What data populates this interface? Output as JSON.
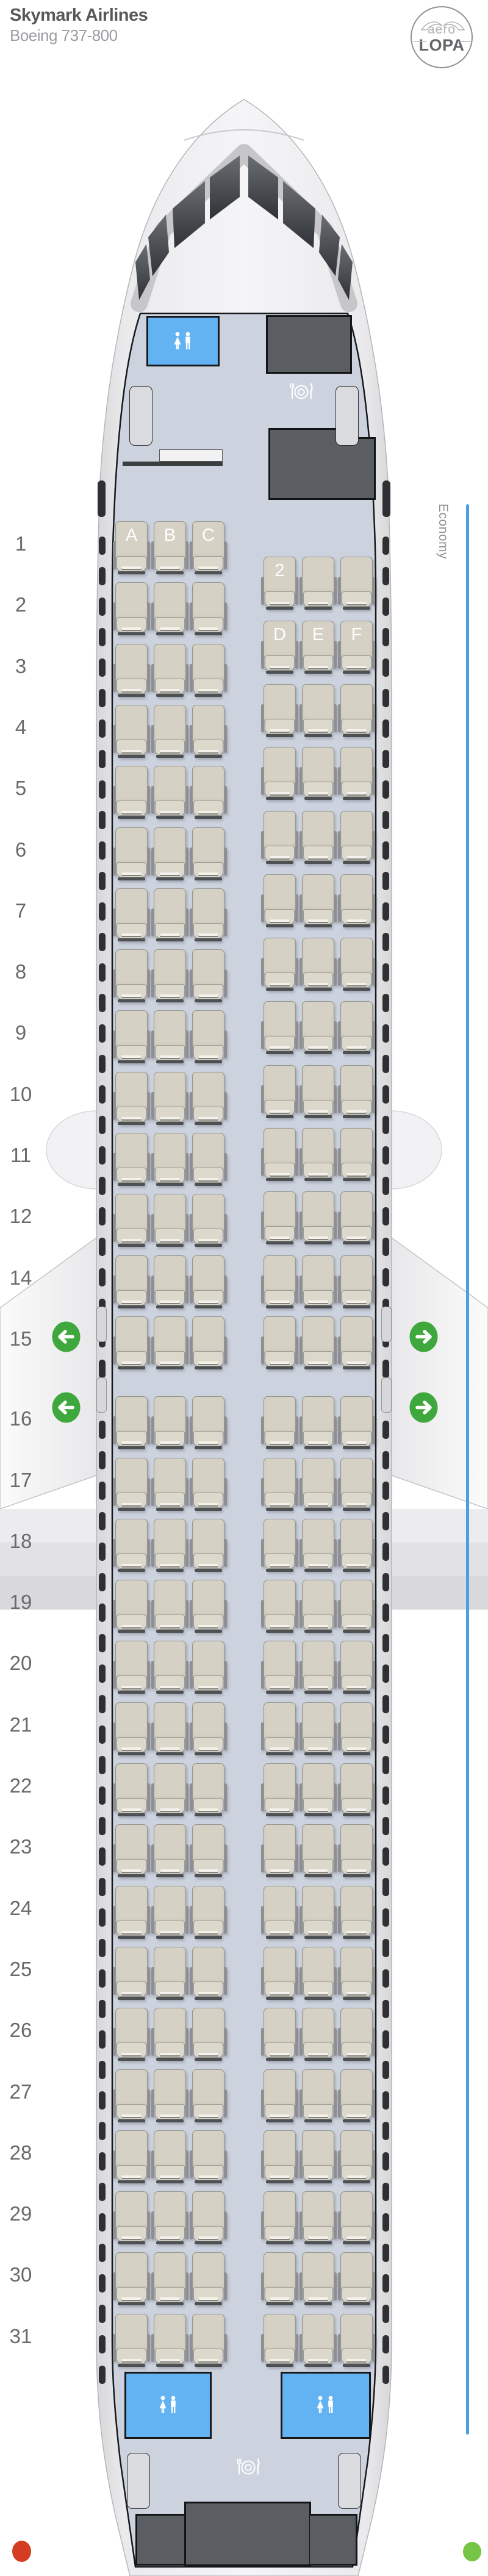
{
  "header": {
    "title": "Skymark Airlines",
    "subtitle": "Boeing 737-800"
  },
  "logo": {
    "top": "aero",
    "bottom": "LOPA"
  },
  "section_label": "Economy",
  "seatmap": {
    "left_columns": [
      "A",
      "B",
      "C"
    ],
    "right_columns": [
      "D",
      "E",
      "F"
    ],
    "left_rows": [
      1,
      2,
      3,
      4,
      5,
      6,
      7,
      8,
      9,
      10,
      11,
      12,
      14,
      15,
      16,
      17,
      18,
      19,
      20,
      21,
      22,
      23,
      24,
      25,
      26,
      27,
      28,
      29,
      30,
      31
    ],
    "right_rows": [
      2,
      3,
      4,
      5,
      6,
      7,
      8,
      9,
      10,
      11,
      12,
      14,
      15,
      16,
      17,
      18,
      19,
      20,
      21,
      22,
      23,
      24,
      25,
      26,
      27,
      28,
      29,
      30,
      31
    ],
    "left_letter_row": 1,
    "right_letter_row": 3,
    "right_first_row_label": "2",
    "exit_rows": [
      15,
      16
    ],
    "facilities": {
      "front": [
        "lavatory",
        "galley",
        "galley",
        "closet"
      ],
      "rear": [
        "lavatory",
        "lavatory",
        "galley"
      ]
    }
  },
  "colors": {
    "accent_blue": "#4a9fe8",
    "lavatory_blue": "#63b3f2",
    "exit_green": "#3fa83c",
    "marker_red": "#d43d22",
    "marker_green": "#77c544",
    "seat_fill": "#d6d1c5",
    "floor": "#cdd3de",
    "galley_grey": "#5a5e62"
  }
}
